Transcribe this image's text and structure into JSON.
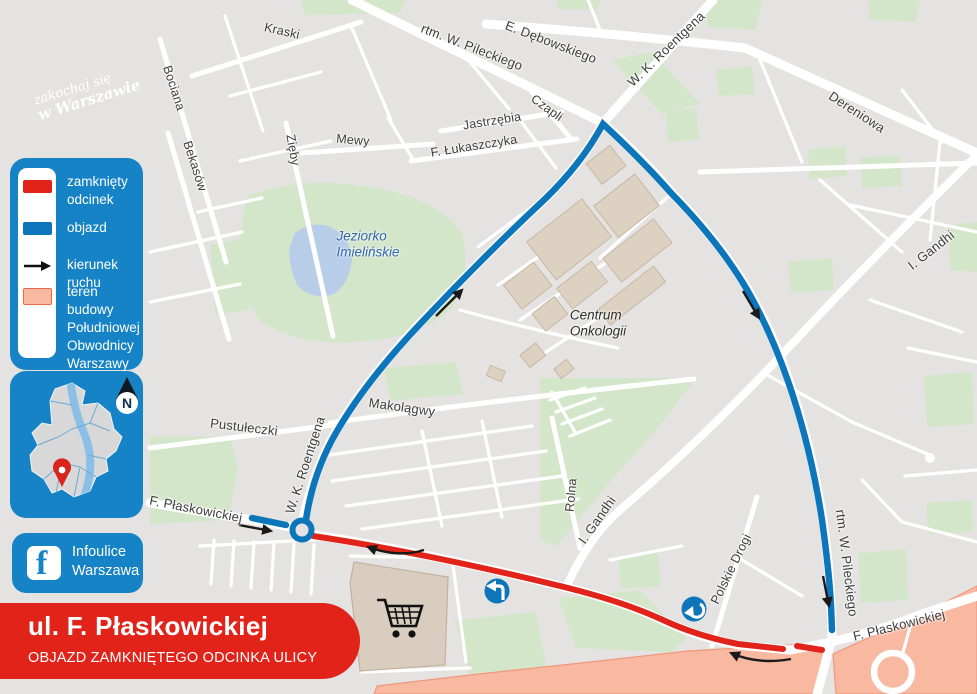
{
  "branding": {
    "logo_line1": "zakochaj się",
    "logo_line2": "w Warszawie"
  },
  "legend": {
    "items": [
      {
        "key": "closed-section",
        "label": "zamknięty odcinek"
      },
      {
        "key": "detour",
        "label": "objazd"
      },
      {
        "key": "traffic-direction",
        "label": "kierunek ruchu"
      },
      {
        "key": "construction-area",
        "label": "teren budowy Południowej Obwodnicy Warszawy"
      }
    ]
  },
  "minimap": {
    "compass_label": "N"
  },
  "social": {
    "network": "facebook",
    "line1": "Infoulice",
    "line2": "Warszawa"
  },
  "banner": {
    "title": "ul. F. Płaskowickiej",
    "subtitle": "OBJAZD ZAMKNIĘTEGO ODCINKA ULICY"
  },
  "colors": {
    "panel_blue": "#1583c5",
    "detour_blue": "#0d76bb",
    "closed_red": "#e2231a",
    "construction_salmon": "#f8b9a0",
    "map_bg": "#e4e3e1",
    "green": "#d4e6ca",
    "lake": "#b7cde8",
    "building": "#ddd1c2"
  },
  "map": {
    "street_labels": [
      {
        "text": "Kraski",
        "x": 282,
        "y": 31,
        "rot": 13,
        "fs": 12.5
      },
      {
        "text": "Bociana",
        "x": 174,
        "y": 88,
        "rot": 72,
        "fs": 12.5
      },
      {
        "text": "Bekasów",
        "x": 195,
        "y": 166,
        "rot": 72,
        "fs": 12.5
      },
      {
        "text": "Zięby",
        "x": 293,
        "y": 150,
        "rot": 80,
        "fs": 12.5
      },
      {
        "text": "Mewy",
        "x": 353,
        "y": 140,
        "rot": 5,
        "fs": 12.5
      },
      {
        "text": "rtm. W. Pileckiego",
        "x": 472,
        "y": 47,
        "rot": 21,
        "fs": 13
      },
      {
        "text": "E. Dębowskiego",
        "x": 551,
        "y": 42,
        "rot": 21,
        "fs": 13
      },
      {
        "text": "W. K. Roentgena",
        "x": 666,
        "y": 49,
        "rot": -44,
        "fs": 13
      },
      {
        "text": "Czapli",
        "x": 547,
        "y": 108,
        "rot": 36,
        "fs": 12.5
      },
      {
        "text": "Dereniowa",
        "x": 857,
        "y": 112,
        "rot": 33,
        "fs": 13
      },
      {
        "text": "Jastrzębia",
        "x": 492,
        "y": 121,
        "rot": -9,
        "fs": 12.5
      },
      {
        "text": "F. Łukaszczyka",
        "x": 474,
        "y": 146,
        "rot": -9,
        "fs": 12.5
      },
      {
        "text": "I. Gandhi",
        "x": 931,
        "y": 250,
        "rot": -38,
        "fs": 13
      },
      {
        "text": "I. Gandhi",
        "x": 597,
        "y": 520,
        "rot": -55,
        "fs": 13
      },
      {
        "text": "Rolna",
        "x": 571,
        "y": 495,
        "rot": -85,
        "fs": 12.5
      },
      {
        "text": "Polskie Drogi",
        "x": 731,
        "y": 569,
        "rot": -64,
        "fs": 12.5
      },
      {
        "text": "rtm. W. Pileckiego",
        "x": 847,
        "y": 563,
        "rot": 83,
        "fs": 13
      },
      {
        "text": "F. Płaskowickiej",
        "x": 196,
        "y": 509,
        "rot": 11,
        "fs": 13
      },
      {
        "text": "W. K. Roentgena",
        "x": 305,
        "y": 465,
        "rot": -72,
        "fs": 13
      },
      {
        "text": "Makolągwy",
        "x": 402,
        "y": 407,
        "rot": 8,
        "fs": 13
      },
      {
        "text": "Pustułeczki",
        "x": 244,
        "y": 427,
        "rot": 7,
        "fs": 13
      },
      {
        "text": "F. Płaskowickiej",
        "x": 899,
        "y": 625,
        "rot": -14,
        "fs": 13
      }
    ],
    "poi_labels": [
      {
        "text": "Jeziorko\nImielińskie",
        "x": 368,
        "y": 244,
        "fs": 13.5,
        "color": "#2f66ad"
      },
      {
        "text": "Centrum\nOnkologii",
        "x": 598,
        "y": 323,
        "fs": 13.5,
        "color": "#2f2f2f"
      }
    ]
  }
}
